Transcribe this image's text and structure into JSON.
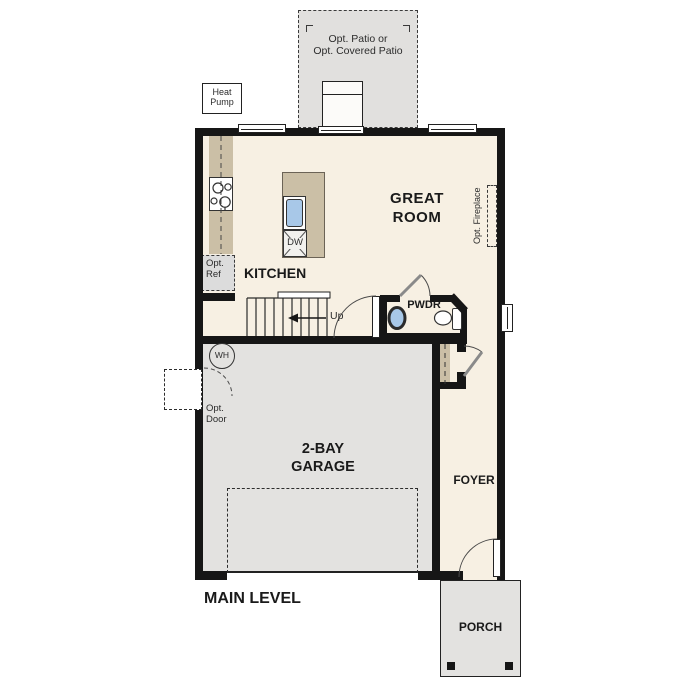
{
  "plan": {
    "level_label": "MAIN LEVEL"
  },
  "rooms": {
    "great_room": "GREAT\nROOM",
    "kitchen": "KITCHEN",
    "powder": "PWDR",
    "foyer": "FOYER",
    "garage": "2-BAY\nGARAGE",
    "porch": "PORCH"
  },
  "labels": {
    "patio": "Opt. Patio or\nOpt. Covered Patio",
    "heat_pump": "Heat\nPump",
    "opt_ref": "Opt.\nRef",
    "opt_door": "Opt.\nDoor",
    "opt_fireplace": "Opt. Fireplace",
    "water_heater": "WH",
    "dishwasher": "DW",
    "stairs_up": "Up"
  },
  "colors": {
    "wall": "#161616",
    "floor": "#f7f0e3",
    "garage_floor": "#e3e2e0",
    "patio": "#e1e0de",
    "porch": "#e3e2e0",
    "counter": "#cbbfa6",
    "sink_blue": "#a8c8e8",
    "opt_ref_fill": "#dcdcdc"
  }
}
